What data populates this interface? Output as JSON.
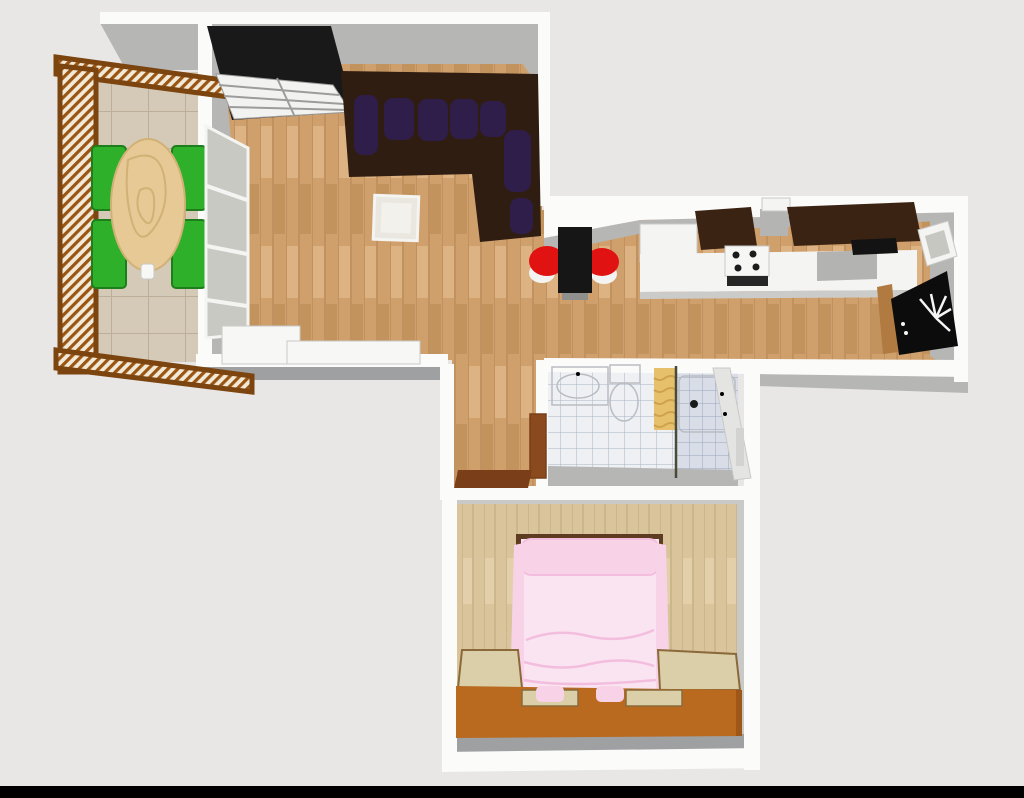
{
  "palette": {
    "bg": "#e8e7e5",
    "frame_black": "#000000",
    "wall_white": "#fbfbfa",
    "wall_gray": "#b6b6b5",
    "wall_gray_dark": "#9fa0a2",
    "wall_gray_light": "#c9c9c7",
    "wood": "#d0a06c",
    "wood_line": "#b9895a",
    "wood_light": "#ddb384",
    "wood_dark": "#c3935e",
    "wood_bedroom": "#d9c49c",
    "wood_bedroom_line": "#c4ac82",
    "wood_bedroom_light": "#e3d0aa",
    "tile_balcony": "#d4cab7",
    "tile_balcony_line": "#bcae98",
    "tile_bath": "#eef0f4",
    "tile_bath_line": "#aab3c4",
    "tile_shower": "#d8dde7",
    "tile_shower_line": "#9ba7bb",
    "rail_brown": "#9a5513",
    "rail_cream": "#f2ead8",
    "rail_edge": "#7c440f",
    "green_chair": "#2fb02a",
    "green_chair_dark": "#1d7f1b",
    "table_wood": "#e6c994",
    "table_wood_line": "#d2b176",
    "wardrobe_black": "#191919",
    "wardrobe_panel": "#f2f2f1",
    "wardrobe_gap": "#9c9c9c",
    "sofa": "#301d11",
    "cushion": "#2f1d4a",
    "side_table": "#eae7e0",
    "side_table_top": "#f3f1eb",
    "white_furniture": "#f7f7f6",
    "bar_table": "#161616",
    "stool_red": "#e11212",
    "stool_base": "#f3f3f1",
    "shadow": "#8f8f8d",
    "counter": "#f4f4f3",
    "counter_shadow": "#cbcbca",
    "cabinet_dark": "#3b2314",
    "hood": "#b4b4b2",
    "oven_dark": "#262626",
    "stove": "#f6f6f5",
    "burner": "#1b1b1b",
    "appliance_gray": "#b3b3b1",
    "cooktop": "#131313",
    "fridge": "#0c0c0c",
    "fridge_detail": "#f5f5f5",
    "fridge_wood": "#b07a40",
    "window_frame": "#f4f4f2",
    "window_glass": "#c7c7c2",
    "door_glass": "#c9c9c4",
    "sink": "#fbfbfb",
    "towel": "#e6c06a",
    "towel_dark": "#cfa24e",
    "divider": "#4a4a38",
    "drain": "#1a1a1a",
    "door_brown": "#8a4a1e",
    "sill": "#7a3f18",
    "bath_door": "#e4e4e2",
    "bath_door_slot": "#d3d3d1",
    "pink": "#fbe4f2",
    "pink_mid": "#f8d3e8",
    "pink_dark": "#f3bedd",
    "bed_frame": "#5e3c22",
    "base_orange": "#b96a1e",
    "base_orange_dark": "#9e5717",
    "beige": "#dbcfa9",
    "beige_edge": "#8a6a3a"
  },
  "scene": {
    "type": "3d-floor-plan-top-view",
    "rooms": [
      {
        "name": "balcony",
        "floor": "beige-tiles",
        "furniture": [
          "oval-wood-table",
          "green-chair",
          "green-chair",
          "green-chair",
          "green-chair",
          "wood-slat-railing"
        ]
      },
      {
        "name": "living-room",
        "floor": "wood-parquet",
        "furniture": [
          "black-white-wardrobe",
          "dark-corner-sofa",
          "purple-cushions",
          "side-table",
          "sideboard",
          "glass-balcony-door"
        ]
      },
      {
        "name": "kitchen",
        "floor": "wood-parquet",
        "furniture": [
          "black-bar-table",
          "red-stool",
          "red-stool",
          "white-counter-run",
          "dark-upper-cabinets",
          "stove-with-burners",
          "counter-appliance",
          "dark-cooktop",
          "black-appliance",
          "wall-window"
        ]
      },
      {
        "name": "bathroom",
        "floor": "light-blue-tiles",
        "furniture": [
          "washbasin-cabinet",
          "toilet",
          "gold-towel-radiator",
          "shower-tray-with-drain",
          "white-door",
          "brown-entry-door"
        ]
      },
      {
        "name": "hallway",
        "floor": "wood-parquet",
        "furniture": [
          "brown-door-threshold"
        ]
      },
      {
        "name": "bedroom",
        "floor": "pale-wood-planks",
        "furniture": [
          "pink-double-bed",
          "pillow",
          "orange-bed-base",
          "beige-nightstand",
          "beige-bench-cabinet",
          "drawer-front",
          "drawer-front"
        ]
      }
    ]
  }
}
